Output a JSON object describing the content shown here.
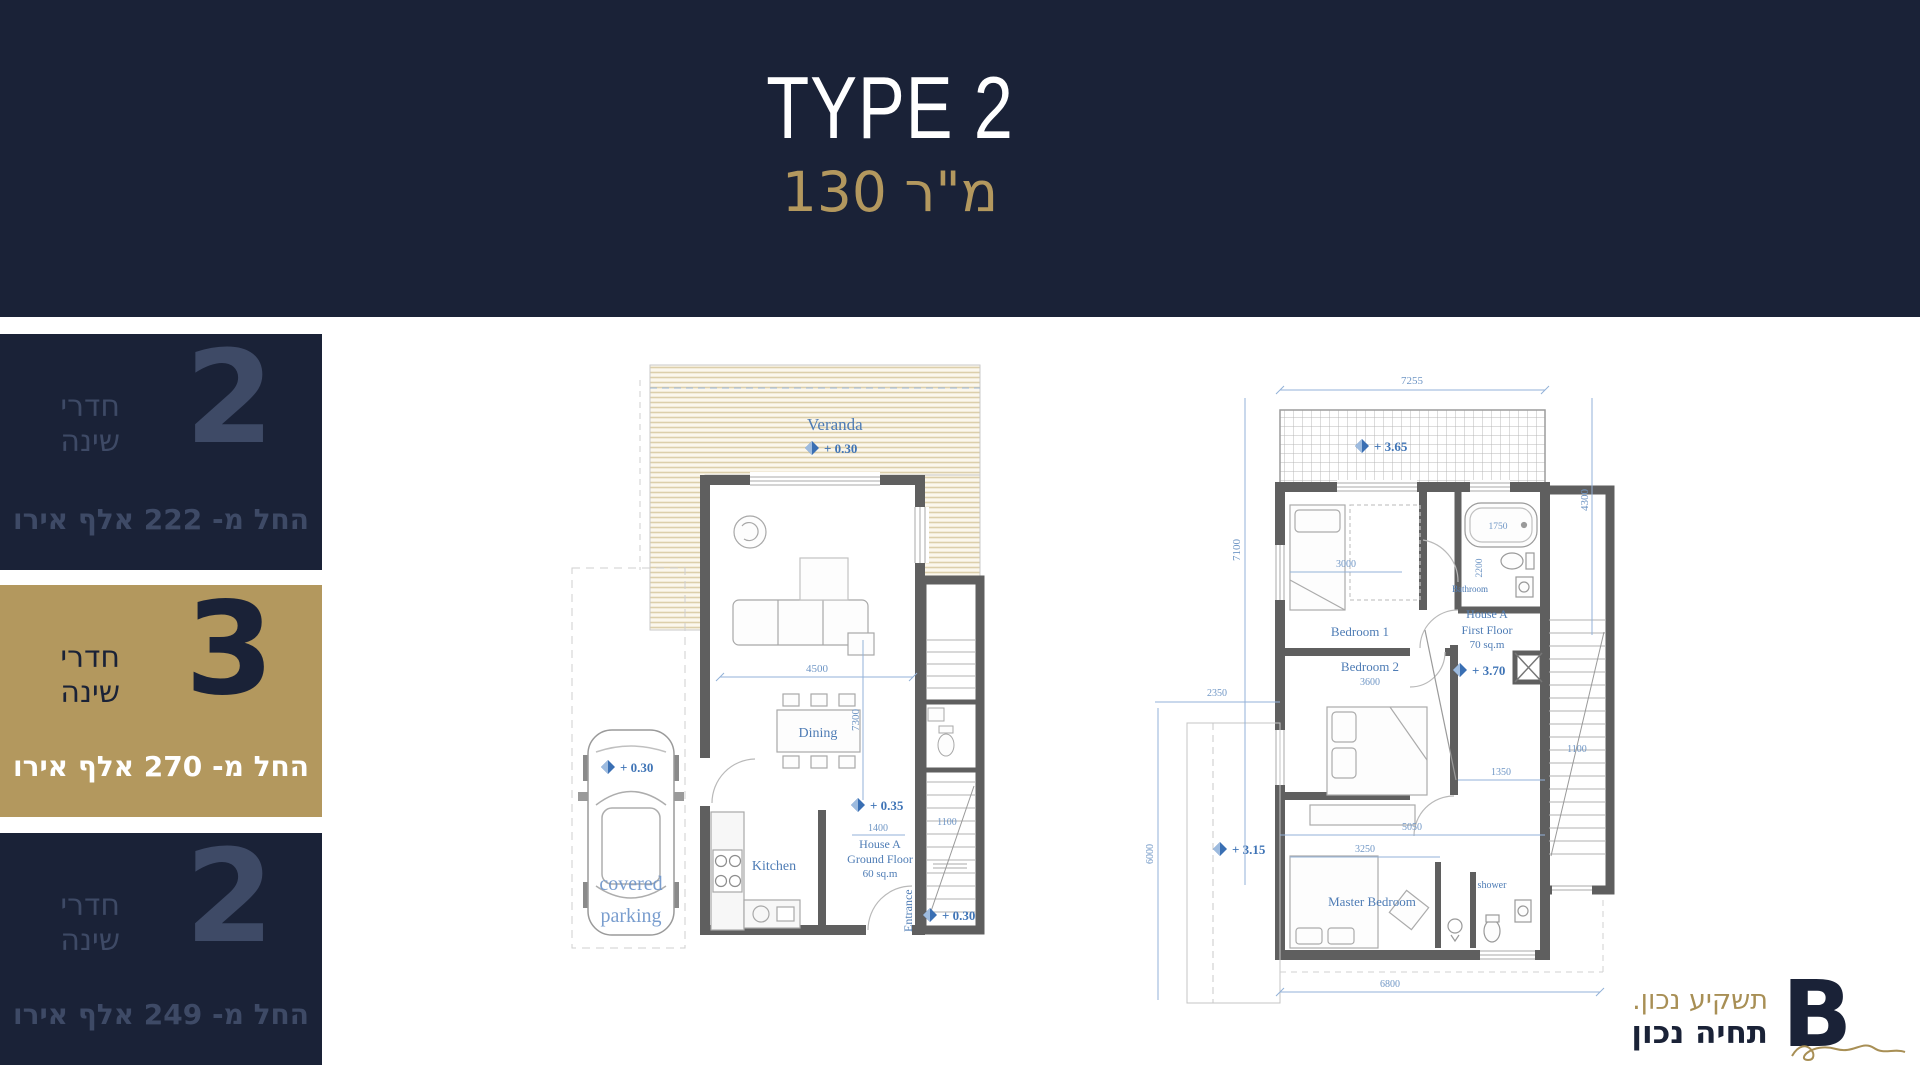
{
  "header": {
    "title": "TYPE 2",
    "subtitle": "130 מ\"ר"
  },
  "sidebar": {
    "cards": [
      {
        "count": "2",
        "label_top": "חדרי",
        "label_bottom": "שינה",
        "price": "החל מ- 222 אלף אירו"
      },
      {
        "count": "3",
        "label_top": "חדרי",
        "label_bottom": "שינה",
        "price": "החל מ- 270 אלף אירו"
      },
      {
        "count": "2",
        "label_top": "חדרי",
        "label_bottom": "שינה",
        "price": "החל מ- 249 אלף אירו"
      }
    ]
  },
  "ground_floor": {
    "veranda": "Veranda",
    "veranda_level": "+ 0.30",
    "covered": "covered",
    "parking": "parking",
    "parking_level": "+ 0.30",
    "dining": "Dining",
    "kitchen": "Kitchen",
    "house": "House A",
    "floor": "Ground Floor",
    "area": "60 sq.m",
    "entrance": "Entrance",
    "level_inner": "+ 0.35",
    "level_entry": "+ 0.30",
    "dim_4500": "4500",
    "dim_7300": "7300",
    "dim_1400": "1400",
    "dim_1100": "1100"
  },
  "first_floor": {
    "dim_7255": "7255",
    "balcony_level": "+ 3.65",
    "bedroom1": "Bedroom 1",
    "dim_3000": "3000",
    "bathroom": "Bathroom",
    "dim_1750": "1750",
    "dim_2200": "2200",
    "bedroom2": "Bedroom 2",
    "dim_3600": "3600",
    "house": "House A",
    "floor": "First Floor",
    "area": "70 sq.m",
    "level_inner": "+ 3.70",
    "master": "Master Bedroom",
    "shower": "shower",
    "terrace_level": "+ 3.15",
    "dim_7100": "7100",
    "dim_4300": "4300",
    "dim_2350": "2350",
    "dim_6000": "6000",
    "dim_6800": "6800",
    "dim_5050": "5050",
    "dim_3250": "3250",
    "dim_1350": "1350",
    "dim_1100": "1100"
  },
  "logo": {
    "tagline_top": "תשקיע נכון.",
    "tagline_bottom": "תחיה נכון",
    "mark": "B"
  }
}
